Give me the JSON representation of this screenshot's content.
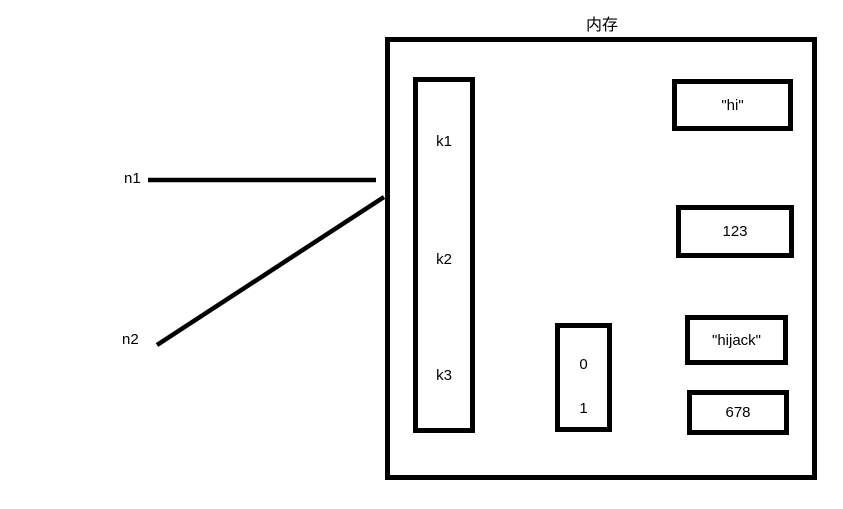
{
  "diagram": {
    "title": "内存",
    "pointers": [
      {
        "label": "n1"
      },
      {
        "label": "n2"
      }
    ],
    "keys": [
      "k1",
      "k2",
      "k3"
    ],
    "index_box": [
      "0",
      "1"
    ],
    "values": [
      "\"hi\"",
      "123",
      "\"hijack\"",
      "678"
    ],
    "colors": {
      "stroke": "#000000",
      "background": "#ffffff"
    }
  }
}
